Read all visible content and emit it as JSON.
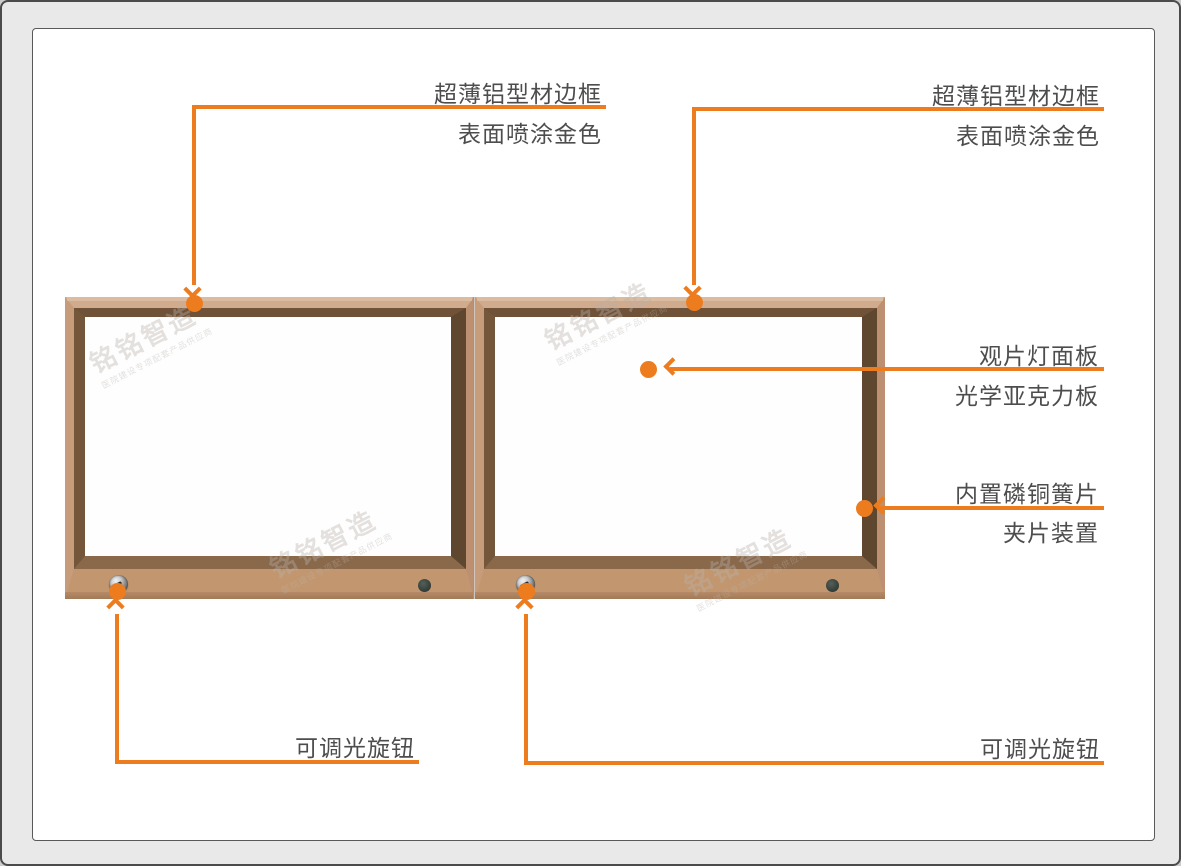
{
  "page": {
    "background": "#e9e9e9",
    "accent_orange": "#ED7C1E",
    "label_color": "#4d4d4d",
    "frame_gold": "#c79c7a",
    "frame_bevel_brown": "#6f5238",
    "panel_white": "#fefefe"
  },
  "annotations": {
    "frame_left": {
      "line1": "超薄铝型材边框",
      "line2": "表面喷涂金色"
    },
    "frame_right": {
      "line1": "超薄铝型材边框",
      "line2": "表面喷涂金色"
    },
    "panel": {
      "line1": "观片灯面板",
      "line2": "光学亚克力板"
    },
    "clip": {
      "line1": "内置磷铜簧片",
      "line2": "夹片装置"
    },
    "dimmer_left": {
      "line1": "可调光旋钮"
    },
    "dimmer_right": {
      "line1": "可调光旋钮"
    }
  },
  "watermark": {
    "title": "铭铭智造",
    "subtitle": "医院建设专项配套产品供应商"
  }
}
